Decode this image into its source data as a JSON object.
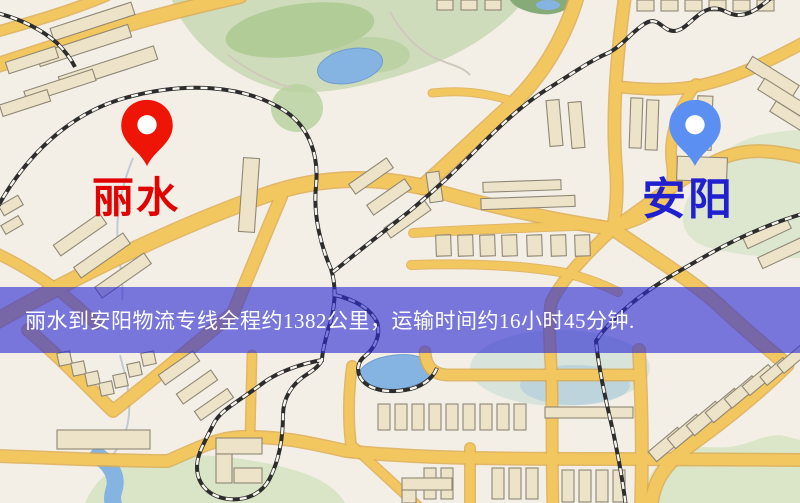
{
  "route_banner": {
    "text": "丽水到安阳物流专线全程约1382公里，运输时间约16小时45分钟.",
    "bg_color": "#2b2bd4",
    "text_color": "#ffffff"
  },
  "origin": {
    "name": "丽水",
    "label_color": "#e00300",
    "pin_color": "#ee1506"
  },
  "destination": {
    "name": "安阳",
    "label_color": "#2020cf",
    "pin_color": "#5b8ff2"
  },
  "map_colors": {
    "background": "#f4efe6",
    "road_fill": "#f2c75f",
    "road_casing": "#dca94b",
    "park_green": "#cfdcbc",
    "water_blue": "#85b4e2",
    "building_fill": "#ece3c9",
    "building_stroke": "#8f8775",
    "railway_dark": "#2d2d2d"
  }
}
